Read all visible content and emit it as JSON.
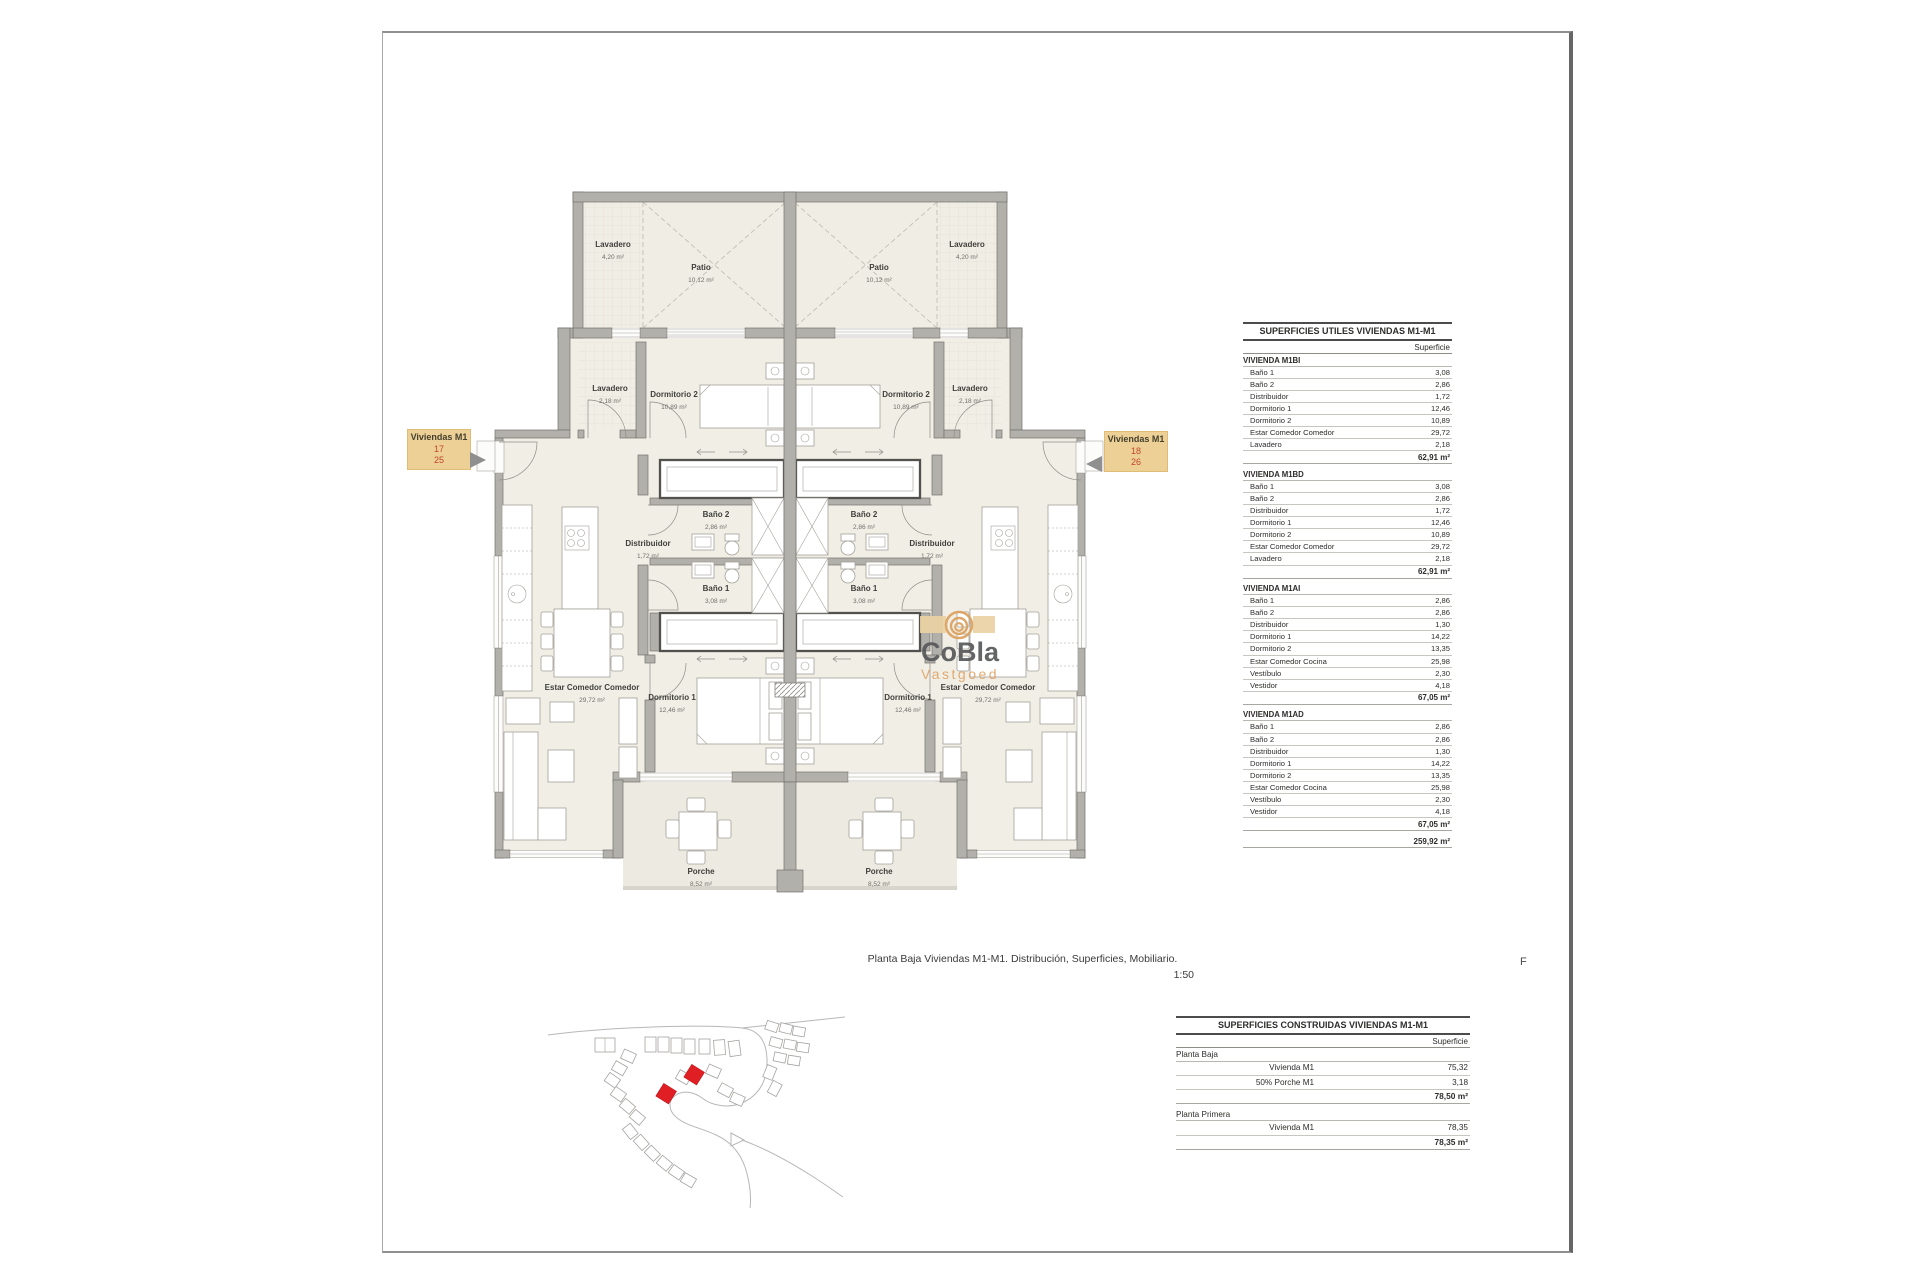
{
  "caption": {
    "line1": "Planta Baja Viviendas M1-M1. Distribución, Superficies, Mobiliario.",
    "scale": "1:50"
  },
  "sheet": {
    "letter_f": "F"
  },
  "watermark": {
    "brand": "CoBla",
    "sub": "Vastgoed"
  },
  "unit_labels": {
    "left": {
      "title": "Viviendas M1",
      "num1": "17",
      "num2": "25"
    },
    "right": {
      "title": "Viviendas M1",
      "num1": "18",
      "num2": "26"
    }
  },
  "rooms": {
    "lavadero_patio": {
      "name": "Lavadero",
      "area": "4,20 m²"
    },
    "patio": {
      "name": "Patio",
      "area": "10,12 m²"
    },
    "lavadero": {
      "name": "Lavadero",
      "area": "2,18 m²"
    },
    "dormitorio2": {
      "name": "Dormitorio 2",
      "area": "10,89 m²"
    },
    "distribuidor": {
      "name": "Distribuidor",
      "area": "1,72 m²"
    },
    "bano2": {
      "name": "Baño 2",
      "area": "2,86 m²"
    },
    "bano1": {
      "name": "Baño 1",
      "area": "3,08 m²"
    },
    "dormitorio1": {
      "name": "Dormitorio 1",
      "area": "12,46 m²"
    },
    "estar": {
      "name": "Estar Comedor Comedor",
      "area": "29,72 m²"
    },
    "porche": {
      "name": "Porche",
      "area": "8,52 m²"
    }
  },
  "tables": {
    "utiles": {
      "title": "SUPERFICIES UTILES VIVIENDAS M1-M1",
      "col_header": "Superficie",
      "sections": [
        {
          "name": "VIVIENDA M1BI",
          "rows": [
            [
              "Baño 1",
              "3,08"
            ],
            [
              "Baño 2",
              "2,86"
            ],
            [
              "Distribuidor",
              "1,72"
            ],
            [
              "Dormitorio 1",
              "12,46"
            ],
            [
              "Dormitorio 2",
              "10,89"
            ],
            [
              "Estar Comedor Comedor",
              "29,72"
            ],
            [
              "Lavadero",
              "2,18"
            ]
          ],
          "total": "62,91 m²"
        },
        {
          "name": "VIVIENDA M1BD",
          "rows": [
            [
              "Baño 1",
              "3,08"
            ],
            [
              "Baño 2",
              "2,86"
            ],
            [
              "Distribuidor",
              "1,72"
            ],
            [
              "Dormitorio 1",
              "12,46"
            ],
            [
              "Dormitorio 2",
              "10,89"
            ],
            [
              "Estar Comedor Comedor",
              "29,72"
            ],
            [
              "Lavadero",
              "2,18"
            ]
          ],
          "total": "62,91 m²"
        },
        {
          "name": "VIVIENDA M1AI",
          "rows": [
            [
              "Baño 1",
              "2,86"
            ],
            [
              "Baño 2",
              "2,86"
            ],
            [
              "Distribuidor",
              "1,30"
            ],
            [
              "Dormitorio 1",
              "14,22"
            ],
            [
              "Dormitorio 2",
              "13,35"
            ],
            [
              "Estar Comedor Cocina",
              "25,98"
            ],
            [
              "Vestíbulo",
              "2,30"
            ],
            [
              "Vestidor",
              "4,18"
            ]
          ],
          "total": "67,05 m²"
        },
        {
          "name": "VIVIENDA M1AD",
          "rows": [
            [
              "Baño 1",
              "2,86"
            ],
            [
              "Baño 2",
              "2,86"
            ],
            [
              "Distribuidor",
              "1,30"
            ],
            [
              "Dormitorio 1",
              "14,22"
            ],
            [
              "Dormitorio 2",
              "13,35"
            ],
            [
              "Estar Comedor Cocina",
              "25,98"
            ],
            [
              "Vestíbulo",
              "2,30"
            ],
            [
              "Vestidor",
              "4,18"
            ]
          ],
          "total": "67,05 m²"
        }
      ],
      "grand_total": "259,92 m²"
    },
    "construidas": {
      "title": "SUPERFICIES CONSTRUIDAS VIVIENDAS M1-M1",
      "col_header": "Superficie",
      "sections": [
        {
          "name": "Planta Baja",
          "rows": [
            [
              "Vivienda M1",
              "75,32"
            ],
            [
              "50% Porche M1",
              "3,18"
            ]
          ],
          "total": "78,50 m²"
        },
        {
          "name": "Planta Primera",
          "rows": [
            [
              "Vivienda M1",
              "78,35"
            ]
          ],
          "total": "78,35 m²"
        }
      ]
    }
  },
  "palette": {
    "label_bg": "#ecd096",
    "label_number_red": "#c2462e",
    "wall_gray": "#b2b0aa",
    "floor_cream": "#f1eee6",
    "watermark_tan": "#dfa468",
    "watermark_gray": "#57585a",
    "site_highlight_red": "#e01f25"
  }
}
